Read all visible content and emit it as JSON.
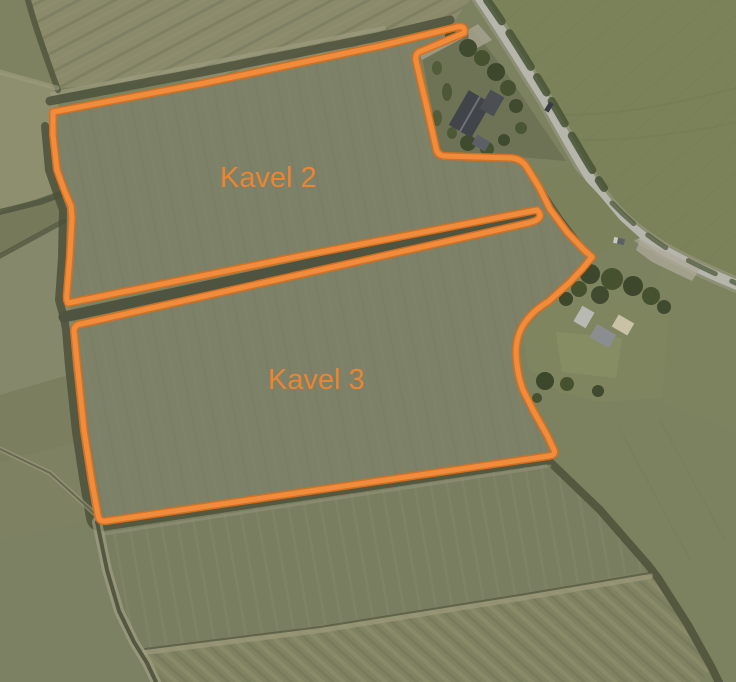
{
  "map": {
    "labels": [
      {
        "id": "kavel-2",
        "text": "Kavel 2"
      },
      {
        "id": "kavel-3",
        "text": "Kavel 3"
      }
    ],
    "colors": {
      "parcel_outline": "#d9701d",
      "parcel_outline_bright": "#f28c3d",
      "label_text": "#ed8431"
    }
  }
}
